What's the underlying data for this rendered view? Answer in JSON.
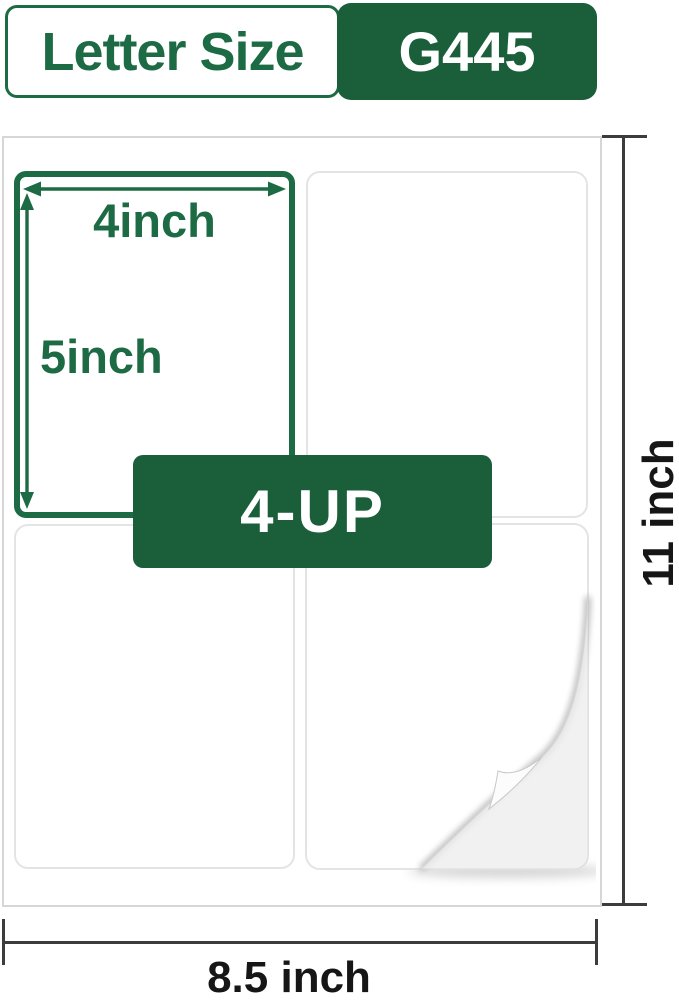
{
  "colors": {
    "green_text": "#1d6b44",
    "green_fill": "#1b5e3a",
    "dim_line": "#3c3c3c",
    "dim_text": "#161616",
    "sheet_border": "#d6d6d6",
    "label_border": "#e4e4e4",
    "backing": "#f1f1f1"
  },
  "header": {
    "size_label": "Letter Size",
    "model_badge": "G445"
  },
  "sheet": {
    "label_width": "4inch",
    "label_height": "5inch",
    "layout": "4-UP",
    "page_height": "11 inch",
    "page_width": "8.5 inch"
  }
}
